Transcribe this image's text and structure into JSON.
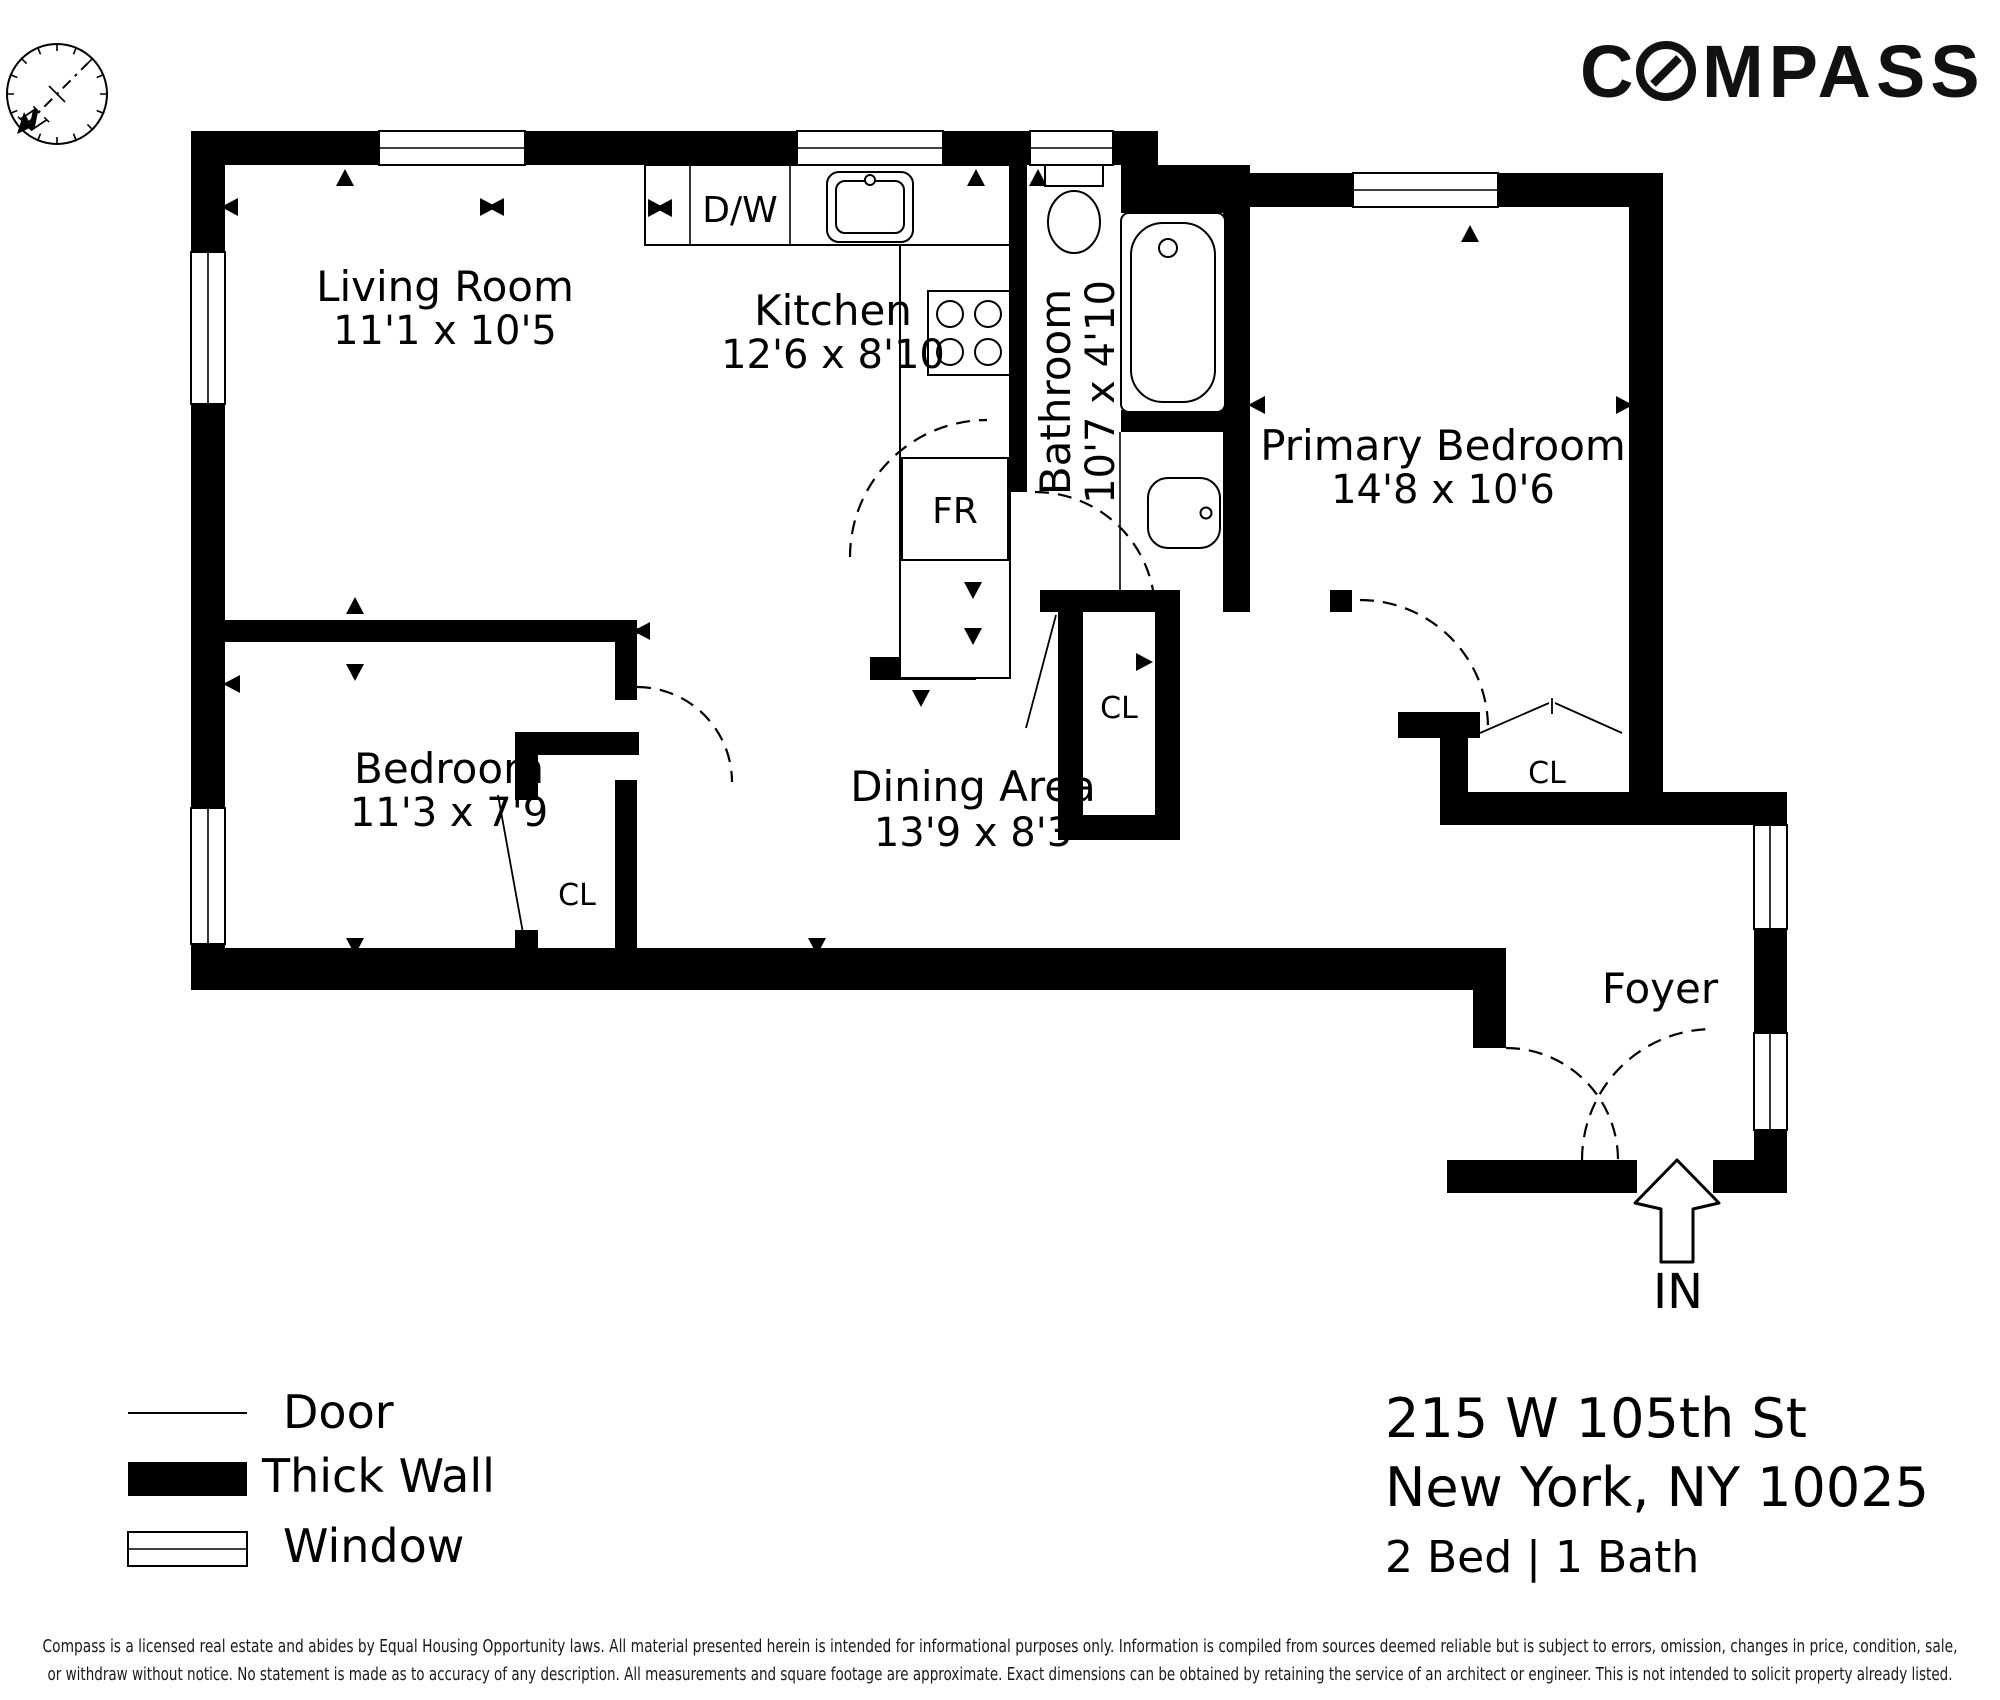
{
  "brand": {
    "c": "C",
    "rest": "MPASS"
  },
  "compass_rose": {
    "north_label": "N"
  },
  "rooms": {
    "living": {
      "name": "Living Room",
      "dims": "11'1 x 10'5"
    },
    "kitchen": {
      "name": "Kitchen",
      "dims": "12'6 x 8'10"
    },
    "bathroom": {
      "name": "Bathroom",
      "dims": "10'7 x 4'10"
    },
    "primary": {
      "name": "Primary Bedroom",
      "dims": "14'8 x 10'6"
    },
    "bedroom": {
      "name": "Bedroom",
      "dims": "11'3 x 7'9"
    },
    "dining": {
      "name": "Dining Area",
      "dims": "13'9 x 8'3"
    },
    "foyer": {
      "name": "Foyer"
    }
  },
  "closets": {
    "bedroom": "CL",
    "hall": "CL",
    "primary": "CL"
  },
  "fixtures": {
    "dishwasher": "D/W",
    "fridge": "FR"
  },
  "entrance": {
    "label": "IN"
  },
  "legend": {
    "door": "Door",
    "thick_wall": "Thick Wall",
    "window": "Window"
  },
  "address": {
    "line1": "215 W 105th St",
    "line2": "New York, NY 10025",
    "line3": "2 Bed | 1 Bath"
  },
  "disclaimer": {
    "line1": "Compass is a licensed real estate and abides by Equal Housing Opportunity laws. All material presented herein is intended for informational purposes only. Information is compiled from sources deemed reliable but is subject to errors, omission, changes in price, condition, sale,",
    "line2": "or withdraw without notice. No statement is made as to accuracy of any description. All measurements and square footage are approximate. Exact dimensions can be obtained by retaining the service of an architect or engineer. This is not intended to solicit property already listed."
  },
  "colors": {
    "ink": "#000000",
    "background": "#ffffff"
  }
}
